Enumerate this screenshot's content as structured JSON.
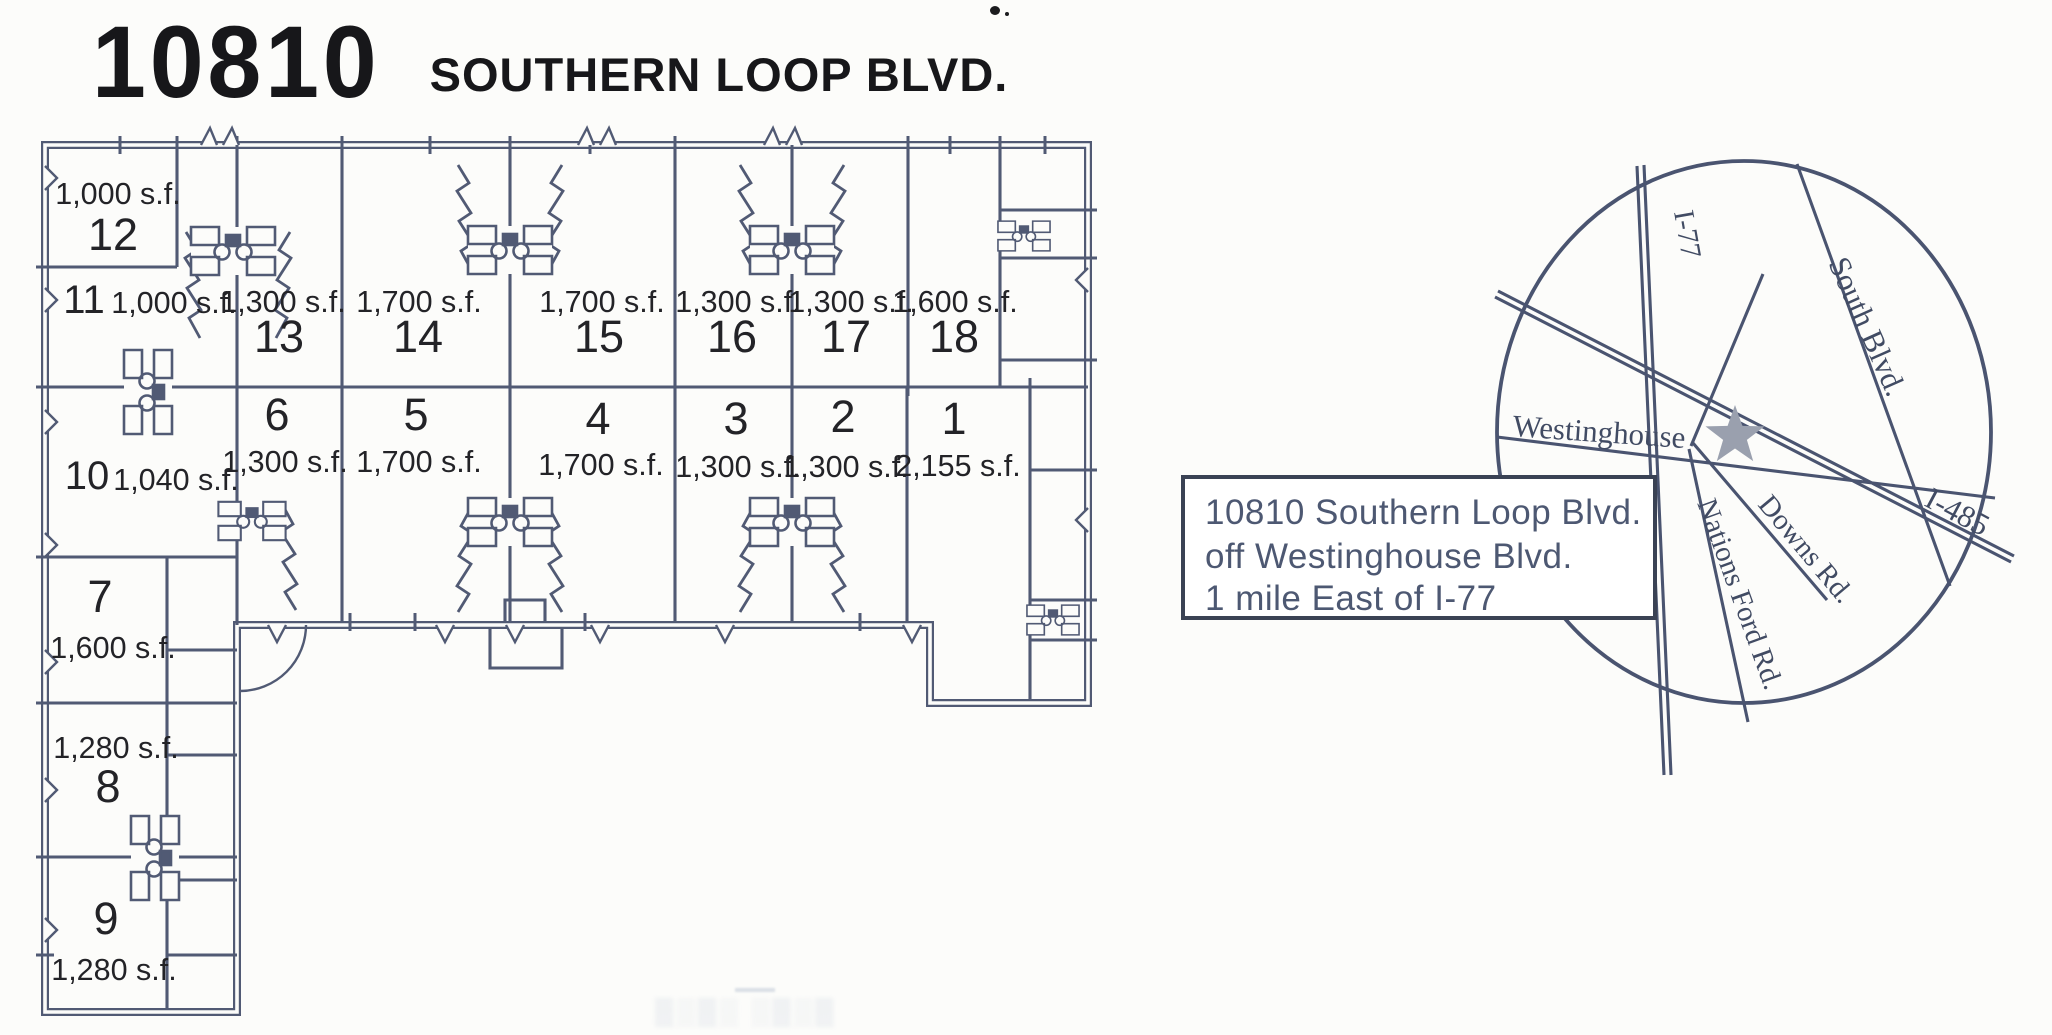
{
  "title": {
    "number": "10810",
    "street": "SOUTHERN LOOP BLVD."
  },
  "floor_plan": {
    "units": [
      {
        "id": "12",
        "sf": "1,000 s.f."
      },
      {
        "id": "11",
        "sf": "1,000 s.f."
      },
      {
        "id": "13",
        "sf": "1,300 s.f."
      },
      {
        "id": "14",
        "sf": "1,700 s.f."
      },
      {
        "id": "15",
        "sf": "1,700 s.f."
      },
      {
        "id": "16",
        "sf": "1,300 s.f."
      },
      {
        "id": "17",
        "sf": "1,300 s.f."
      },
      {
        "id": "18",
        "sf": "1,600 s.f."
      },
      {
        "id": "10",
        "sf": "1,040 s.f."
      },
      {
        "id": "6",
        "sf": "1,300 s.f."
      },
      {
        "id": "5",
        "sf": "1,700 s.f."
      },
      {
        "id": "4",
        "sf": "1,700 s.f."
      },
      {
        "id": "3",
        "sf": "1,300 s.f."
      },
      {
        "id": "2",
        "sf": "1,300 s.f."
      },
      {
        "id": "1",
        "sf": "2,155 s.f."
      },
      {
        "id": "7",
        "sf": "1,600 s.f."
      },
      {
        "id": "8",
        "sf": "1,280 s.f."
      },
      {
        "id": "9",
        "sf": "1,280 s.f."
      }
    ]
  },
  "map": {
    "roads": [
      {
        "label": "I-77"
      },
      {
        "label": "South Blvd."
      },
      {
        "label": "Westinghouse"
      },
      {
        "label": "I-485"
      },
      {
        "label": "Downs Rd."
      },
      {
        "label": "Nations Ford Rd."
      }
    ],
    "marker": "location-star",
    "callout": {
      "line1": "10810 Southern Loop Blvd.",
      "line2": "off Westinghouse Blvd.",
      "line3": "1 mile East of I-77"
    }
  },
  "colors": {
    "plan_line": "#515a74",
    "map_line": "#4a5470",
    "label_text": "#232327",
    "callout_text": "#4d5872",
    "title_text": "#17171a",
    "star": "#9aa0ae",
    "background": "#fcfcfa"
  }
}
